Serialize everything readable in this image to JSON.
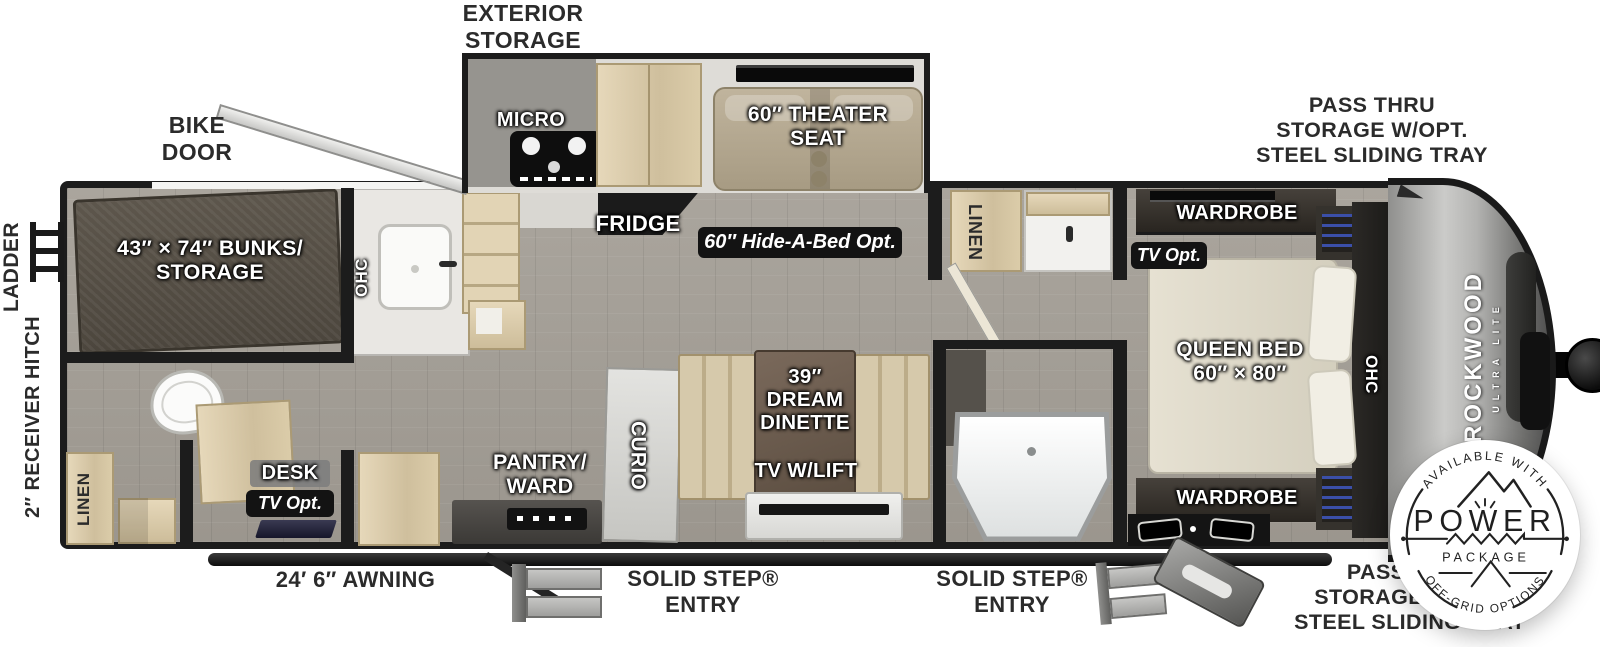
{
  "title": "Travel trailer floor plan",
  "labels": {
    "exterior_storage": "EXTERIOR\nSTORAGE",
    "bike_door": "BIKE\nDOOR",
    "pass_thru_top": "PASS THRU\nSTORAGE W/OPT.\nSTEEL SLIDING TRAY",
    "pass_thru_bottom": "PASS THRU\nSTORAGE W/OPT.\nSTEEL SLIDING TRAY",
    "ladder": "LADDER",
    "receiver_hitch": "2″ RECEIVER HITCH",
    "awning": "24′ 6″ AWNING",
    "entry_front": "SOLID STEP®\nENTRY",
    "entry_rear": "SOLID STEP®\nENTRY"
  },
  "interior": {
    "bunks": "43″ × 74″ BUNKS/\nSTORAGE",
    "ohc_rear": "OHC",
    "micro": "MICRO",
    "theater_seat": "60″ THEATER\nSEAT",
    "fridge": "FRIDGE",
    "hide_a_bed_opt": "60″ Hide-A-Bed Opt.",
    "linen_rear": "LINEN",
    "desk": "DESK",
    "tv_opt_desk": "TV Opt.",
    "pantry_ward": "PANTRY/\nWARD",
    "curio": "CURIO",
    "dream_dinette": "39″\nDREAM\nDINETTE",
    "tv_w_lift": "TV W/LIFT",
    "linen_mid": "LINEN",
    "wardrobe_top": "WARDROBE",
    "tv_opt_bedroom": "TV Opt.",
    "queen_bed": "QUEEN BED\n60″ × 80″",
    "wardrobe_bottom": "WARDROBE",
    "ohc_bedroom": "OHC"
  },
  "brand": {
    "name": "ROCKWOOD",
    "model": "ULTRA LITE"
  },
  "power_badge": {
    "available_with": "AVAILABLE WITH",
    "power": "POWER",
    "package": "PACKAGE",
    "off_grid": "OFF-GRID OPTIONS"
  },
  "colors": {
    "wall": "#1c1c1c",
    "floor_gray": "#a39e96",
    "light_wood": "#d9caa9",
    "bunk_brown": "#575046",
    "theater_tan": "#b2a68e",
    "bed_cream": "#e0dbcb",
    "badge_black": "#131313",
    "label_dark": "#2b2b2b",
    "shelf_blue": "#3b4fa8"
  }
}
